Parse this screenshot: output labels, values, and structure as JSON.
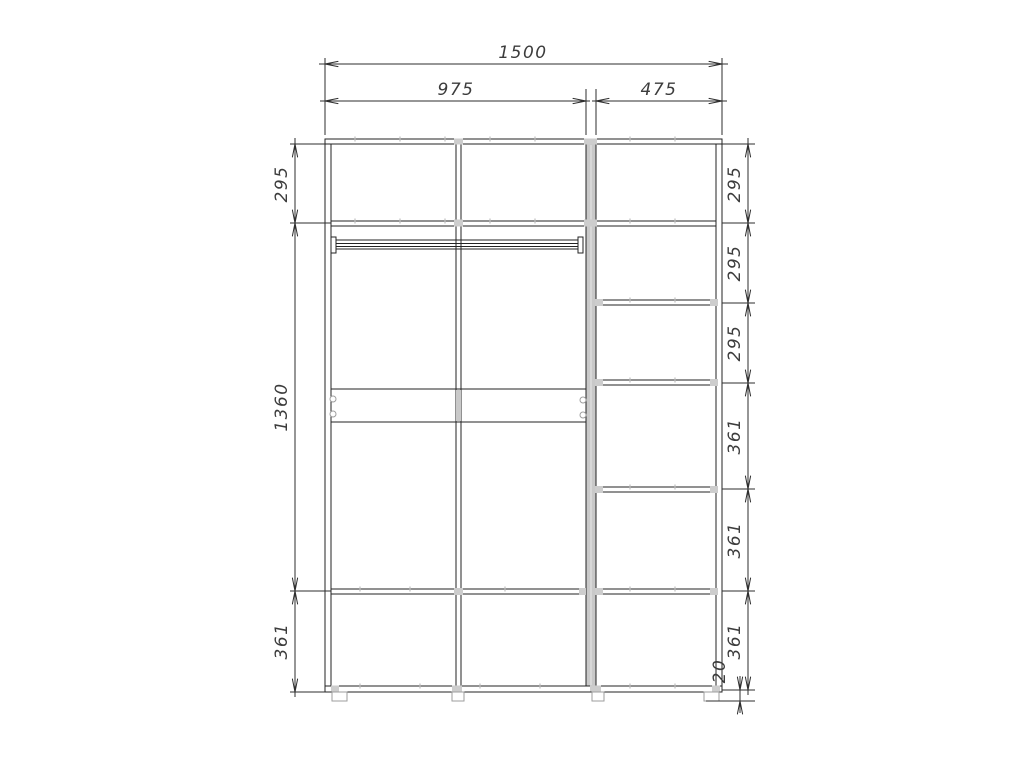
{
  "dimensions": {
    "overall_width": "1500",
    "left_section_width": "975",
    "right_section_width": "475",
    "left_column": [
      "295",
      "1360",
      "361"
    ],
    "right_column": [
      "295",
      "295",
      "295",
      "361",
      "361",
      "361"
    ],
    "base_height": "20"
  },
  "colors": {
    "background": "#ffffff",
    "line": "#232323",
    "dimension_text": "#3c3c3c",
    "panel_section_fill": "#c9c9c9",
    "hardware_gray": "#9e9e9e"
  }
}
